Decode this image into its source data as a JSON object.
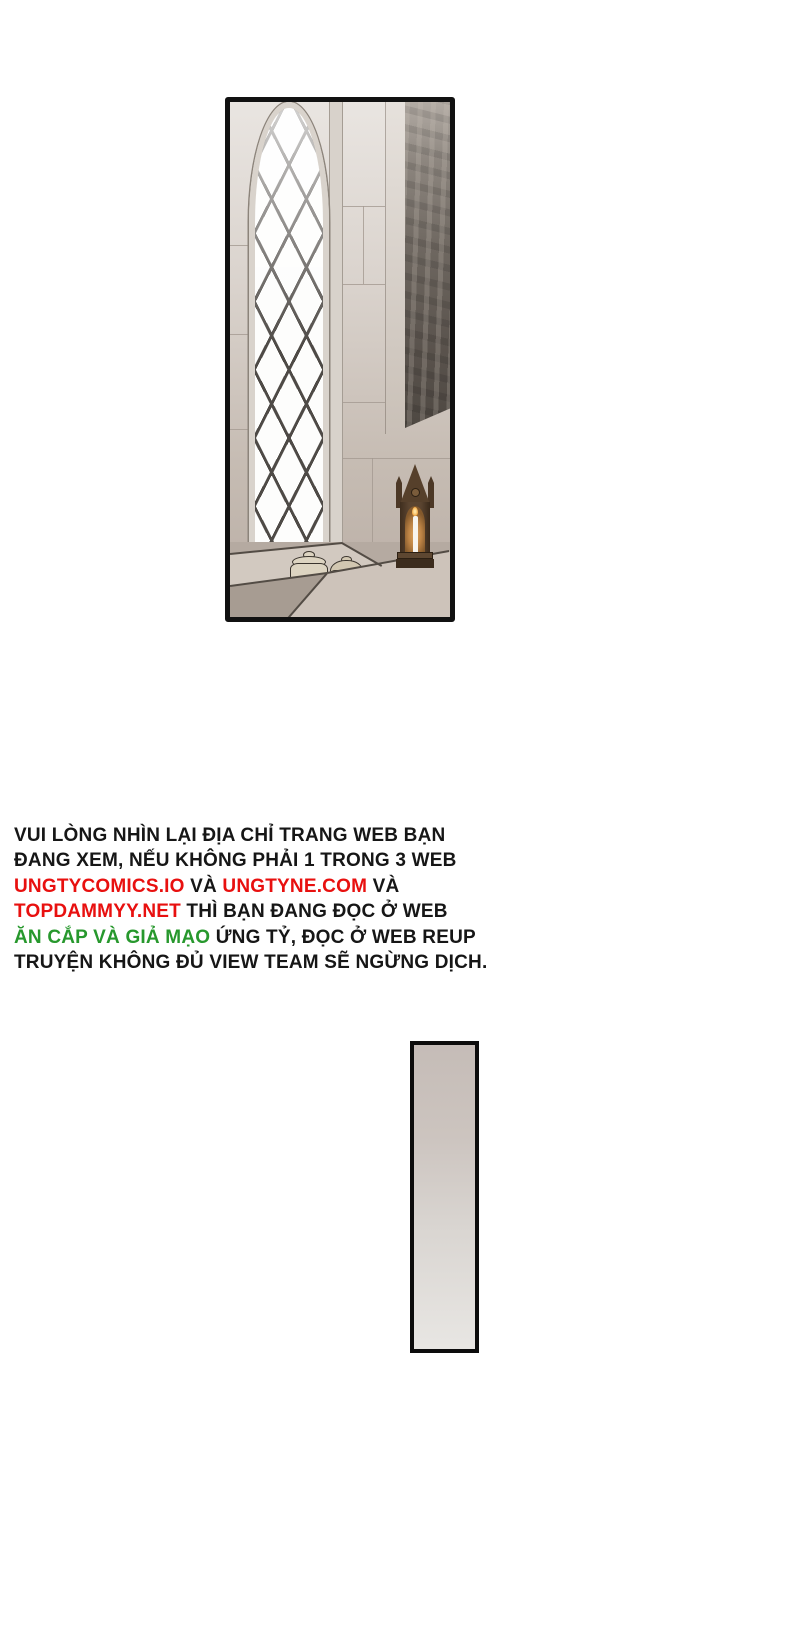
{
  "page": {
    "background_color": "#ffffff"
  },
  "panel": {
    "border_color": "#111111",
    "scene_colors": {
      "wall": "#cfc7c0",
      "window_glass": "#fdfdfc",
      "window_lattice": "#4e4a46",
      "tapestry_shadow": "#544e48",
      "jar_ceramic": "#ddd4c1",
      "shrine_wood": "#4e3a28",
      "candle_glow": "#d9a35f"
    }
  },
  "notice": {
    "colors": {
      "black": "#161616",
      "red": "#e8100f",
      "green": "#27982d"
    },
    "lines": [
      {
        "segments": [
          {
            "text": "VUI LÒNG NHÌN LẠI ĐỊA CHỈ TRANG WEB BẠN",
            "color": "black"
          }
        ]
      },
      {
        "segments": [
          {
            "text": "ĐANG XEM, NẾU KHÔNG PHẢI 1 TRONG 3 WEB",
            "color": "black"
          }
        ]
      },
      {
        "segments": [
          {
            "text": "UNGTYCOMICS.IO",
            "color": "red"
          },
          {
            "text": " VÀ ",
            "color": "black"
          },
          {
            "text": "UNGTYNE.COM",
            "color": "red"
          },
          {
            "text": " VÀ",
            "color": "black"
          }
        ]
      },
      {
        "segments": [
          {
            "text": "TOPDAMMYY.NET",
            "color": "red"
          },
          {
            "text": " THÌ BẠN ĐANG ĐỌC Ở WEB",
            "color": "black"
          }
        ]
      },
      {
        "segments": [
          {
            "text": "ĂN CẮP VÀ GIẢ MẠO",
            "color": "green"
          },
          {
            "text": " ỨNG TỶ, ĐỌC Ở WEB REUP",
            "color": "black"
          }
        ]
      },
      {
        "segments": [
          {
            "text": "TRUYỆN KHÔNG ĐỦ VIEW TEAM SẼ NGỪNG DỊCH.",
            "color": "black"
          }
        ]
      }
    ]
  },
  "gradient_panel": {
    "border_color": "#0c0c0c",
    "top_color": "#c5bcb7",
    "bottom_color": "#e8e6e3"
  }
}
